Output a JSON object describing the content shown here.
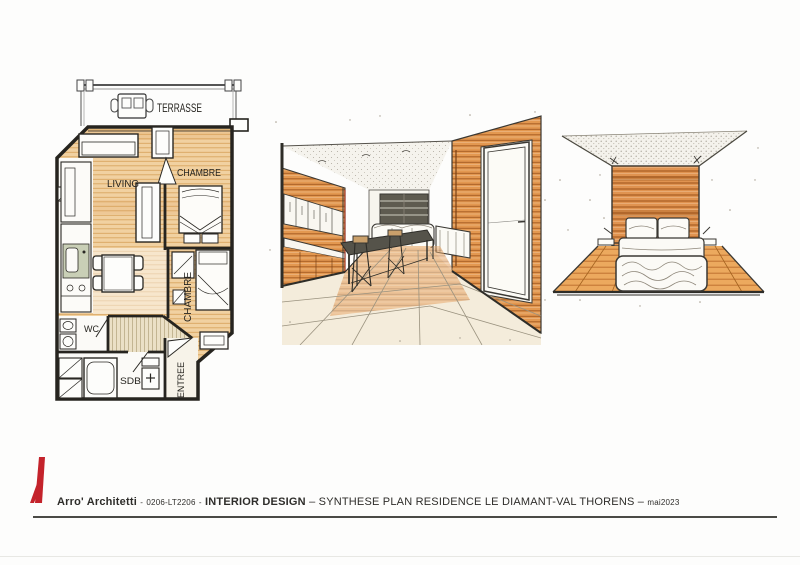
{
  "plan": {
    "labels": {
      "terrasse": "TERRASSE",
      "living": "LIVING",
      "chambre_top": "CHAMBRE",
      "chambre_bottom": "CHAMBRE",
      "wc": "WC",
      "sdb": "SDB",
      "entree": "ENTREE"
    }
  },
  "footer": {
    "firm": "Arro' Architetti",
    "sep_a": "-",
    "code": "0206-LT2206",
    "sep_b": "-",
    "discipline": "INTERIOR DESIGN",
    "sep_c": "–",
    "title": "SYNTHESE PLAN RESIDENCE LE DIAMANT-VAL THORENS",
    "sep_d": "–",
    "date": "mai2023"
  },
  "colors": {
    "logo_red": "#c4232b",
    "plan_wood": "#f1d1a1",
    "plan_wood_line": "#d9a660",
    "tile_fill": "#ebe0c6",
    "tile_line": "#b9aa85",
    "kitchen_counter": "#c9cfb6",
    "sketch_wood": "#e39850",
    "sketch_wood_line": "#a85f24",
    "ink": "#33312c",
    "footer_text": "#2e2d2a",
    "rule": "#4a4a46"
  }
}
